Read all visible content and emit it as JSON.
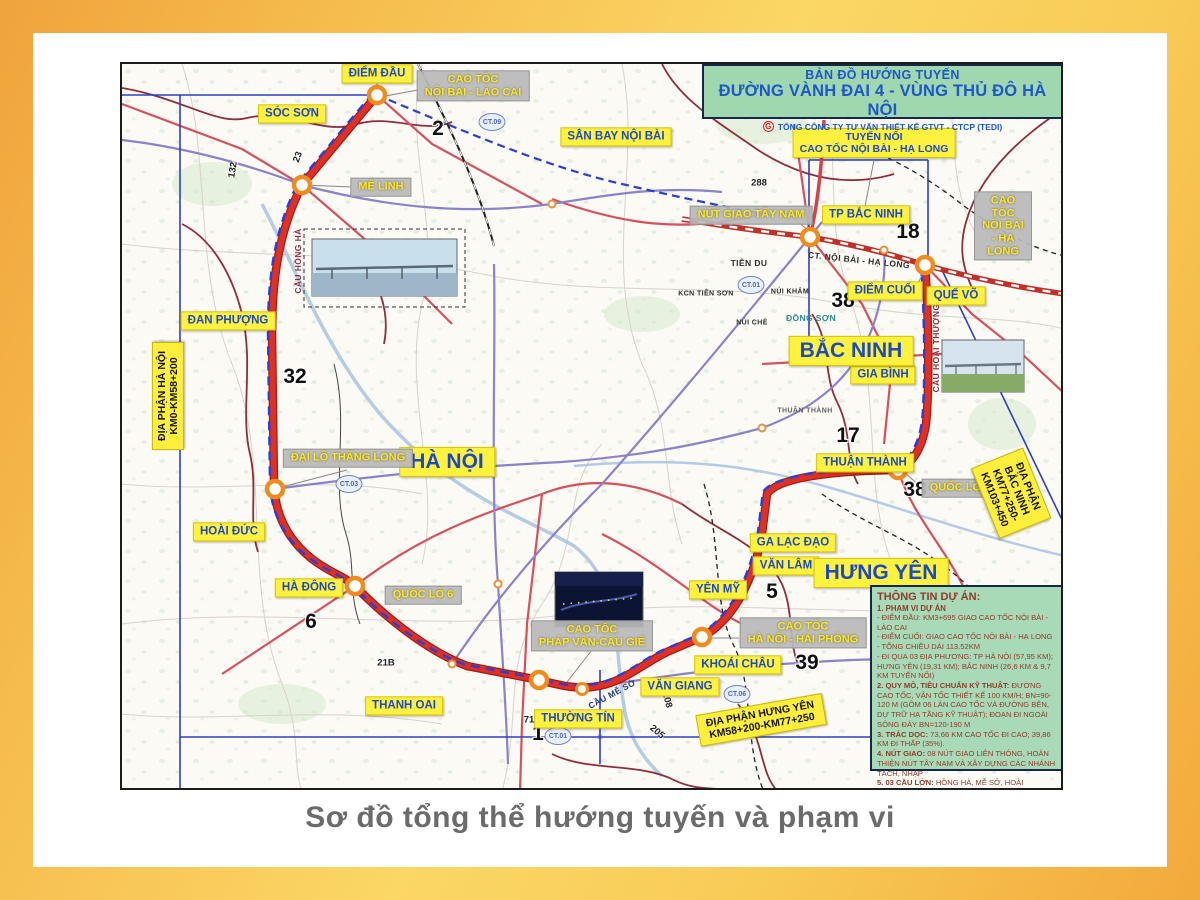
{
  "header": {
    "line1": "BẢN ĐỒ HƯỚNG TUYẾN",
    "line2": "ĐƯỜNG VÀNH ĐAI 4 - VÙNG THỦ ĐÔ HÀ NỘI",
    "org": "TỔNG CÔNG TY TƯ VẤN THIẾT KẾ GTVT - CTCP (TEDI)",
    "logo_letter": "G"
  },
  "caption": "Sơ đồ tổng thể hướng tuyến và phạm vi",
  "labels": {
    "diem_dau": "ĐIỂM ĐẦU",
    "soc_son": "SÓC SƠN",
    "san_bay": "SÂN BAY NỘI BÀI",
    "dan_phuong": "ĐAN PHƯỢNG",
    "hoai_duc": "HOÀI ĐỨC",
    "ha_dong": "HÀ ĐÔNG",
    "thanh_oai": "THANH OAI",
    "thuong_tin": "THƯỜNG TÍN",
    "van_giang": "VĂN GIANG",
    "khoai_chau": "KHOÁI CHÂU",
    "yen_my": "YÊN MỸ",
    "van_lam": "VĂN LÂM",
    "ga_lac_dao": "GA LẠC ĐẠO",
    "thuan_thanh": "THUẬN THÀNH",
    "gia_binh": "GIA BÌNH",
    "que_vo": "QUẾ VÕ",
    "diem_cuoi": "ĐIỂM CUỐI",
    "tp_bac_ninh": "TP BẮC NINH",
    "tuyen_noi": "TUYẾN NỐI\nCAO TỐC NỘI BÀI - HẠ LONG",
    "ha_noi": "HÀ NỘI",
    "bac_ninh": "BẮC NINH",
    "hung_yen": "HƯNG YÊN",
    "nb_lao_cai": "CAO TỐC\nNỘI BÀI - LÀO CAI",
    "me_linh": "MÊ LINH",
    "thang_long": "ĐẠI LỘ THĂNG LONG",
    "ql6": "QUỐC LỘ 6",
    "phap_van": "CAO TỐC\nPHÁP VÂN-CẦU GIẼ",
    "hai_phong": "CAO TỐC\nHÀ NỘI - HẢI PHÒNG",
    "tay_nam": "NÚT GIAO TÂY NAM",
    "nb_ha_long": "CAO TỐC\nNỘI BÀI - HẠ LONG",
    "ql38": "QUỐC LỘ 38",
    "dp_ha_noi": "ĐỊA PHẬN HÀ NỘI\nKM0-KM58+200",
    "dp_hung_yen": "ĐỊA PHẬN HƯNG YÊN\nKM58+200-KM77+250",
    "dp_bac_ninh": "ĐỊA PHẬN BẮC NINH\nKM77+250-KM103+450"
  },
  "notes": {
    "cau_hong_ha": "CẦU HỒNG HÀ",
    "cau_me_so": "CẦU MỄ SỞ",
    "cau_hoai_thuong": "CẦU HOÀI THƯỢNG",
    "ct_nbhl_road": "CT. NỘI BÀI - HẠ LONG",
    "tien_du": "TIÊN DU",
    "kcn_tien_son": "KCN TIÊN SƠN",
    "nui_kham": "NÚI KHÁM",
    "nui_che": "NÚI CHÈ",
    "dong_son": "ĐỒNG SƠN",
    "thuan_thanh_sm": "THUẬN THÀNH"
  },
  "badges": {
    "ct09": "CT.09",
    "ct03": "CT.03",
    "ct01": "CT.01",
    "ct06": "CT.06"
  },
  "numbers": {
    "n2": "2",
    "n23": "23",
    "n132": "132",
    "n32": "32",
    "n6": "6",
    "n21b": "21B",
    "n71": "71",
    "n1": "1",
    "n208": "208",
    "n205": "205",
    "n5": "5",
    "n39": "39",
    "n17": "17",
    "n38": "38",
    "n18": "18",
    "n288": "288"
  },
  "info_box": {
    "title": "THÔNG TIN DỰ ÁN:",
    "s1_head": "1. PHẠM VI DỰ ÁN",
    "s1_l1": "- ĐIỂM ĐẦU: KM3+695 GIAO CAO TỐC NỘI BÀI - LÀO CAI",
    "s1_l2": "- ĐIỂM CUỐI: GIAO CAO TỐC NỘI BÀI - HẠ LONG",
    "s1_l3": "- TỔNG CHIỀU DÀI 113.52KM",
    "s1_l4": "- ĐI QUA 03 ĐỊA PHƯƠNG: TP HÀ NỘI (57,95 KM); HƯNG YÊN (19,31 KM); BẮC NINH (26,6 KM & 9,7 KM TUYẾN NỐI)",
    "s2_head": "2. QUY MÔ, TIÊU CHUẨN KỸ THUẬT:",
    "s2_body": "ĐƯỜNG CAO TỐC, VẬN TỐC THIẾT KẾ 100 KM/H; BN=90-120 M (GỒM 06 LÀN CAO TỐC VÀ ĐƯỜNG BÊN, DỰ TRỮ HẠ TẦNG KỸ THUẬT); ĐOẠN ĐI NGOÀI SÔNG ĐÁY BN=120-190 M",
    "s3_head": "3. TRẮC DỌC:",
    "s3_body": "73,66 KM CAO TỐC ĐI CAO; 39,86 KM ĐI THẤP (35%).",
    "s4_head": "4. NÚT GIAO:",
    "s4_body": "08 NÚT GIAO LIÊN THÔNG, HOÀN THIỆN NÚT TÂY NAM VÀ XÂY DỰNG CÁC NHÁNH TÁCH, NHẬP",
    "s5_head": "5. 03 CẦU LỚN:",
    "s5_body": "HỒNG HÀ, MỄ SỞ, HOÀI THƯỢNG"
  },
  "colors": {
    "route_red": "#e03024",
    "corridor_blue": "#2b3fd6",
    "label_yellow": "#fff23e",
    "label_text_blue": "#1b49c8",
    "gray_box": "#b9b9b9",
    "gray_box_text": "#ffe81a",
    "panel_green": "#a9dab8",
    "panel_text": "#8f3a2a",
    "border_orange": "#f3a93c",
    "node_orange": "#ef8c1d"
  }
}
